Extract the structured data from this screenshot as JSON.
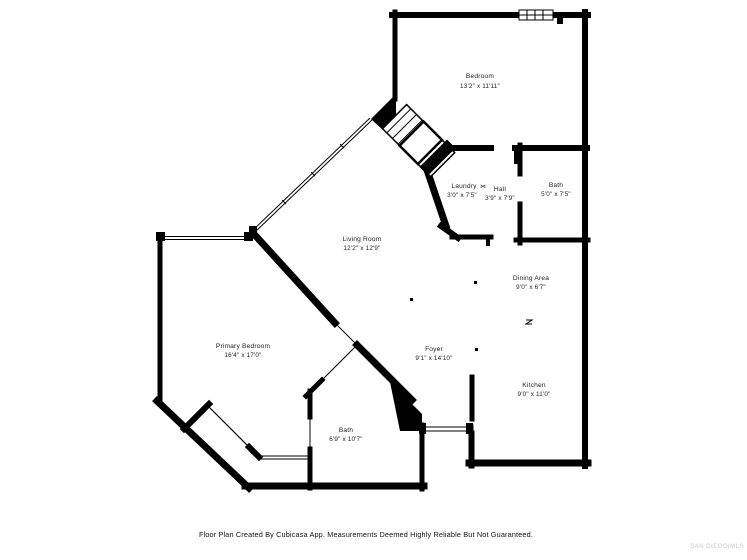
{
  "floor_plan": {
    "rooms": [
      {
        "name": "Bedroom",
        "dims": "13'2\" x 11'11\""
      },
      {
        "name": "Laundry",
        "dims": "3'0\" x 7'5\""
      },
      {
        "name": "Hall",
        "dims": "3'9\" x 7'9\""
      },
      {
        "name": "Bath",
        "dims": "5'0\" x 7'5\""
      },
      {
        "name": "Living Room",
        "dims": "12'2\" x 12'9\""
      },
      {
        "name": "Dining Area",
        "dims": "9'0\" x 6'7\""
      },
      {
        "name": "Foyer",
        "dims": "9'1\" x 14'10\""
      },
      {
        "name": "Primary Bedroom",
        "dims": "16'4\" x 17'0\""
      },
      {
        "name": "Kitchen",
        "dims": "9'0\" x 11'0\""
      },
      {
        "name": "Bath",
        "dims": "6'9\" x 10'7\""
      }
    ],
    "laundry_door_icon": "⋈",
    "colors": {
      "wall": "#000000",
      "background": "#ffffff",
      "watermark": "#c9c9c9"
    }
  },
  "footer": {
    "caption": "Floor Plan Created By Cubicasa App. Measurements Deemed Highly Reliable But Not Guaranteed."
  },
  "watermark": {
    "text": "SAN DIEGO|MLS"
  }
}
